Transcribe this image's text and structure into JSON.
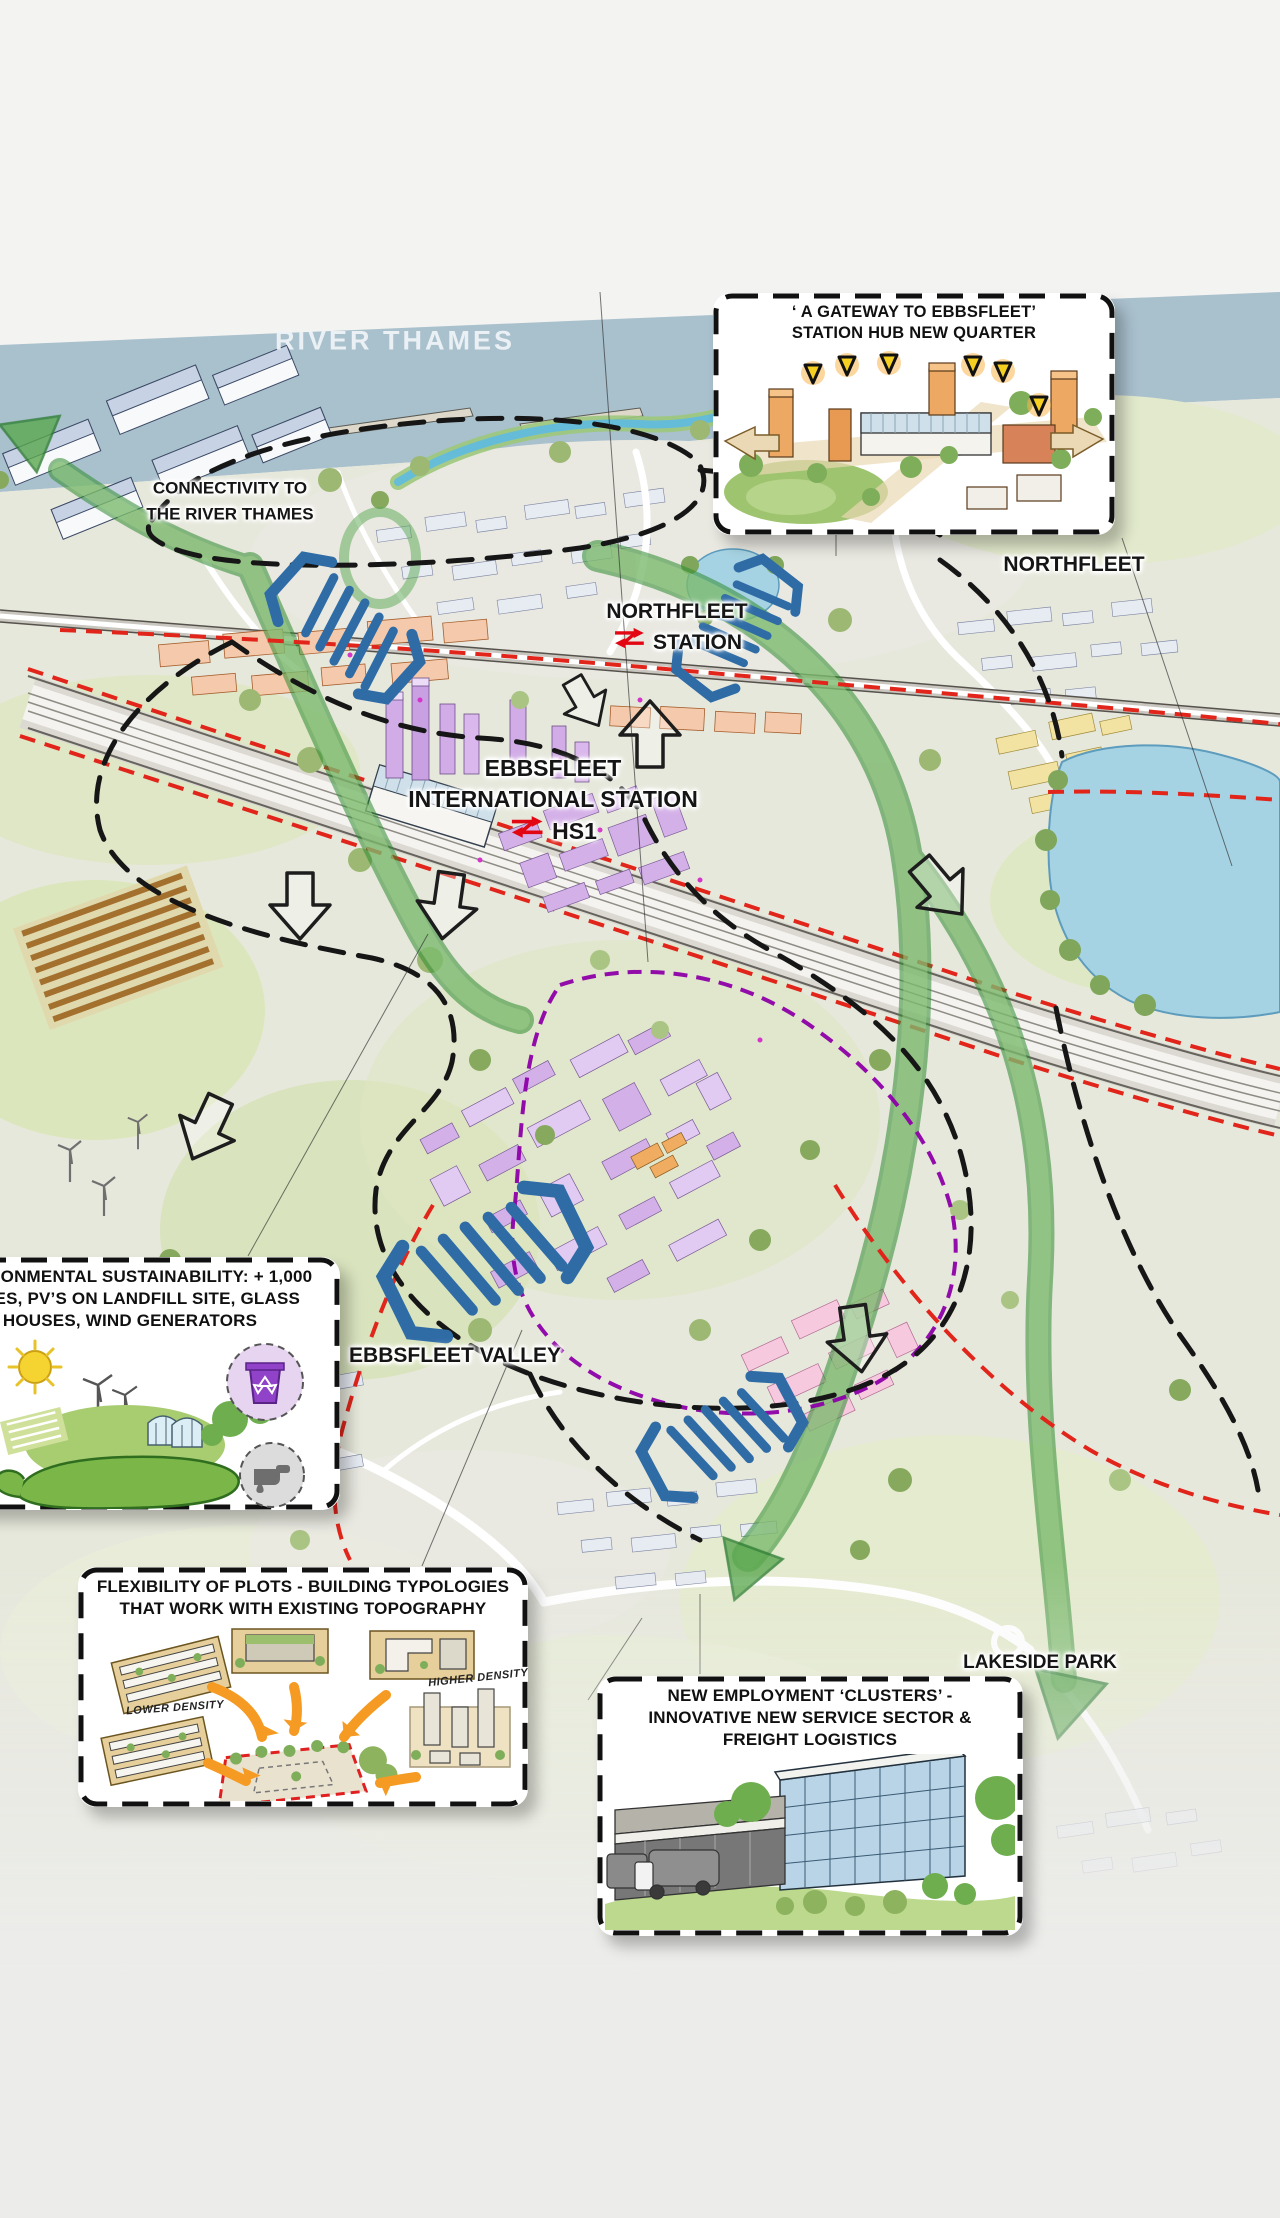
{
  "map": {
    "place_labels": {
      "river_thames": "RIVER THAMES",
      "connectivity": {
        "line1": "CONNECTIVITY TO",
        "line2": "THE RIVER THAMES"
      },
      "northfleet_station": {
        "line1": "NORTHFLEET",
        "line2": "STATION"
      },
      "northfleet": "NORTHFLEET",
      "ebbsfleet_international": {
        "line1": "EBBSFLEET",
        "line2": "INTERNATIONAL STATION",
        "hs1": "HS1"
      },
      "ebbsfleet_valley": "EBBSFLEET VALLEY",
      "lakeside_park": "LAKESIDE PARK"
    },
    "callouts": {
      "gateway": {
        "line1": "‘ A GATEWAY TO EBBSFLEET’",
        "line2": "STATION HUB NEW QUARTER"
      },
      "sustainability": {
        "line1": "ENVIRONMENTAL SUSTAINABILITY: + 1,000",
        "line2": "TREES, PV’S ON LANDFILL SITE, GLASS",
        "line3": "HOUSES, WIND GENERATORS"
      },
      "flexibility": {
        "line1": "FLEXIBILITY OF PLOTS - BUILDING TYPOLOGIES",
        "line2": "THAT WORK WITH EXISTING TOPOGRAPHY",
        "label_lower_density": "LOWER DENSITY",
        "label_higher_density": "HIGHER DENSITY"
      },
      "employment": {
        "line1": "NEW EMPLOYMENT ‘CLUSTERS’ -",
        "line2": "INNOVATIVE NEW SERVICE SECTOR &",
        "line3": "FREIGHT LOGISTICS"
      }
    },
    "colors": {
      "river": "#a9c0cd",
      "lake": "#a6d3e3",
      "new_homes_purple": "#d4b0e8",
      "station_quarter_salmon": "#f5c9ab",
      "employment_pink": "#f6c9de",
      "movement_blue": "#2f6ca6",
      "green_corridor": "#4aa043",
      "boundary_black": "#161616",
      "route_red": "#e1251b",
      "route_purple": "#8d00a8",
      "highlight_orange": "#f59a23",
      "rail_logo_red": "#e30613"
    }
  }
}
